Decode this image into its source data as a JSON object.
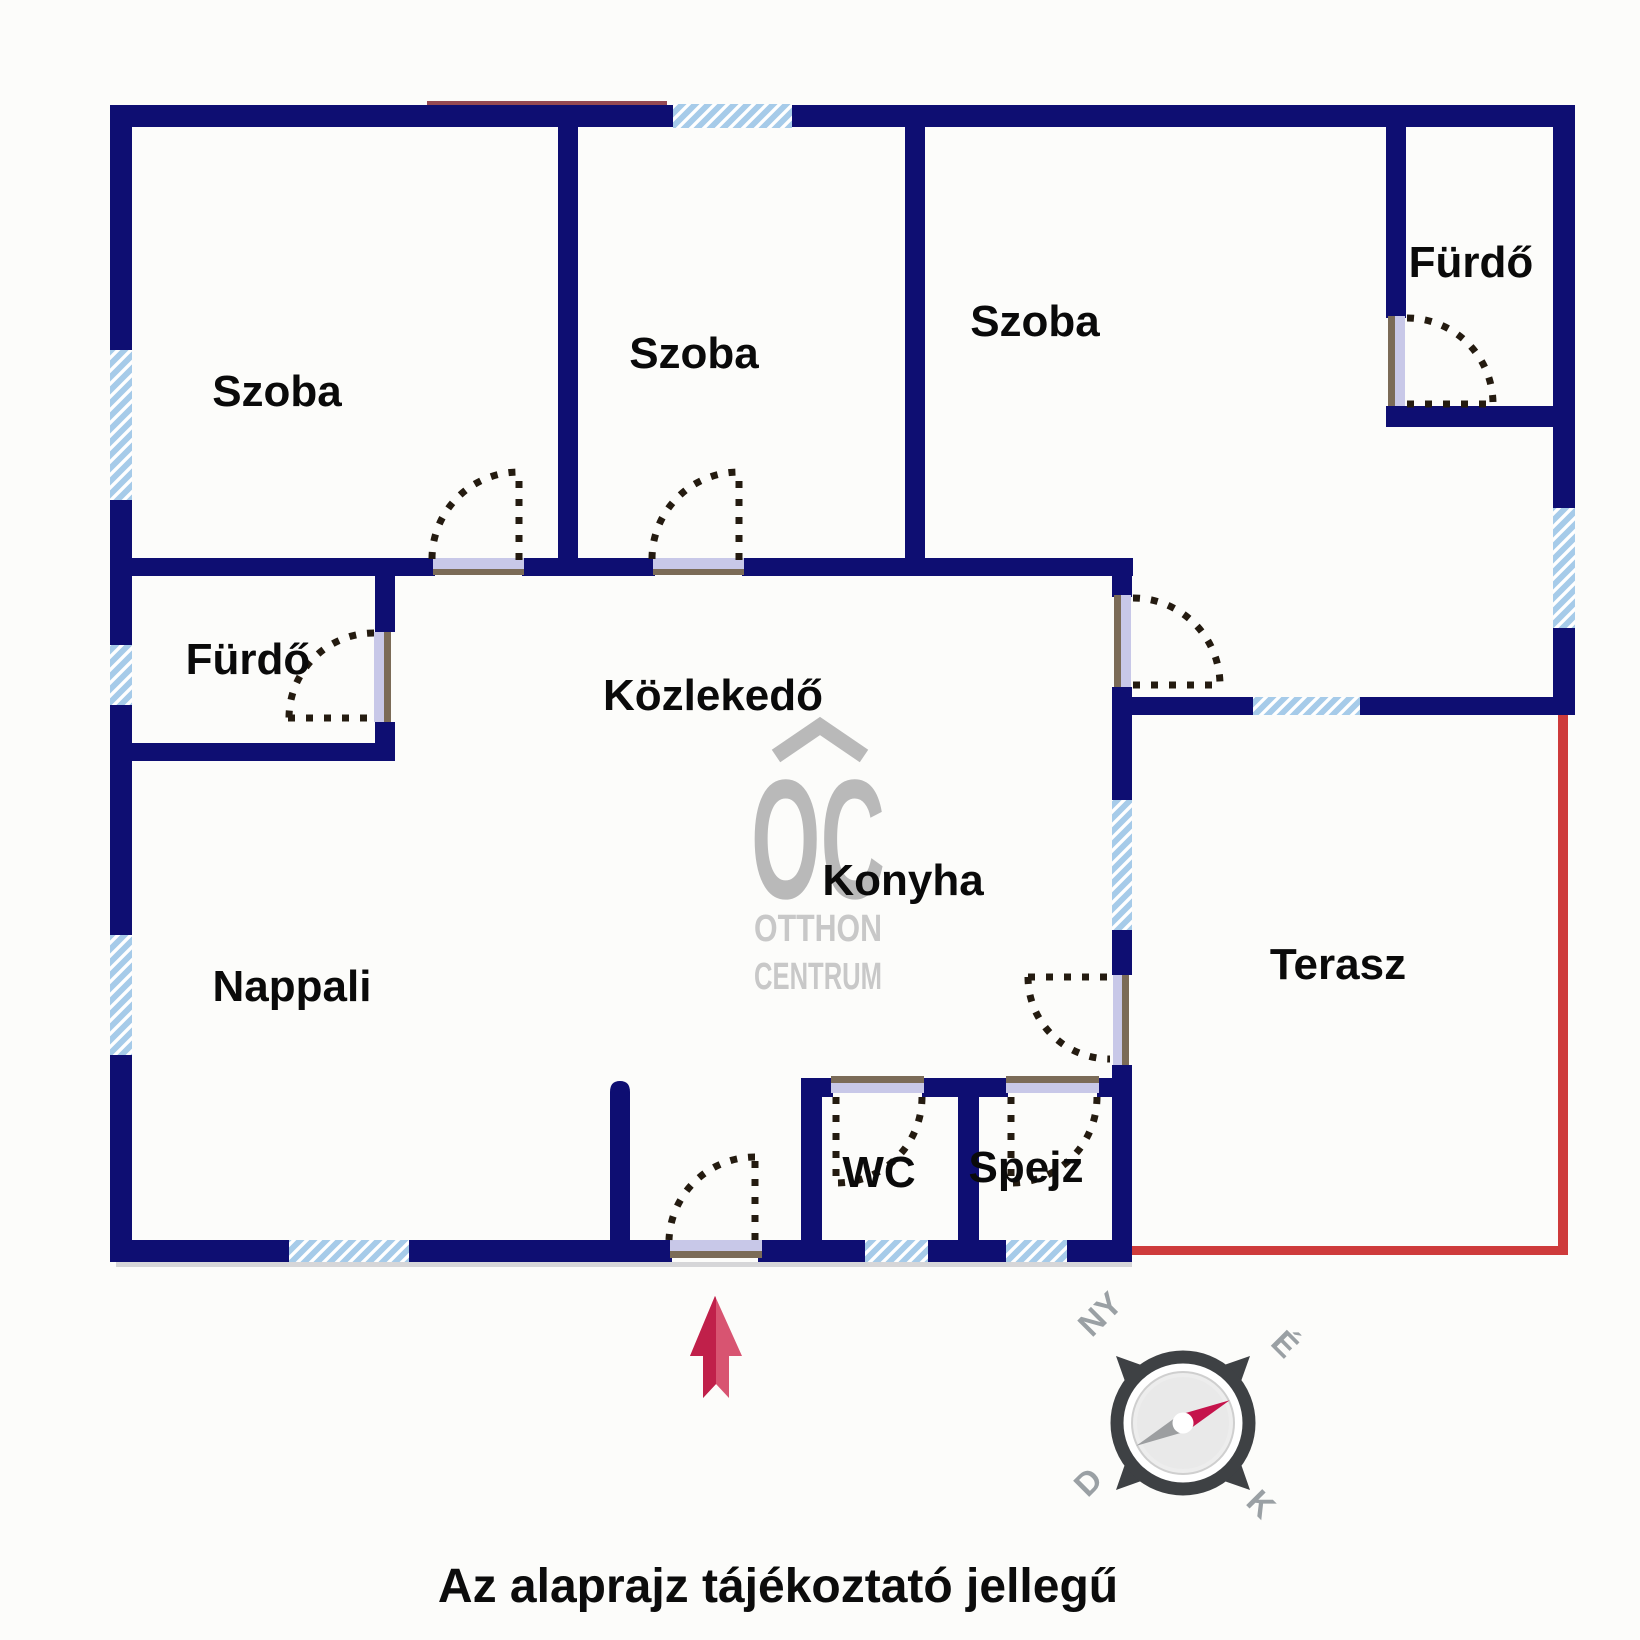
{
  "floorplan": {
    "rooms": [
      {
        "id": "szoba-1",
        "label": "Szoba"
      },
      {
        "id": "szoba-2",
        "label": "Szoba"
      },
      {
        "id": "szoba-3",
        "label": "Szoba"
      },
      {
        "id": "furdo-felso",
        "label": "Fürdő"
      },
      {
        "id": "furdo-also",
        "label": "Fürdő"
      },
      {
        "id": "kozlekedo",
        "label": "Közlekedő"
      },
      {
        "id": "konyha",
        "label": "Konyha"
      },
      {
        "id": "nappali",
        "label": "Nappali"
      },
      {
        "id": "terasz",
        "label": "Terasz"
      },
      {
        "id": "wc",
        "label": "WC"
      },
      {
        "id": "spejz",
        "label": "Spejz"
      }
    ],
    "caption": "Az alaprajz tájékoztató jellegű",
    "watermark": {
      "monogram": "OC",
      "line1": "OTTHON",
      "line2": "CENTRUM"
    },
    "compass": {
      "nw": "NY",
      "ne": "É",
      "sw": "D",
      "se": "K",
      "needle_points": "É"
    },
    "colors": {
      "wall": "#0e0e72",
      "window_fill": "#a6cbe9",
      "window_stripe": "#ffffff",
      "door_sill": "#c8c8e8",
      "door_sill_edge": "#7b6b57",
      "door_swing": "#241b10",
      "open_boundary_red": "#ce3b3b",
      "arrow_dark": "#c0204a",
      "arrow_light": "#d85471",
      "watermark_gray": "#b9b9b9",
      "compass_ring": "#3e4144",
      "compass_needle_red": "#c5134b",
      "compass_needle_gray": "#9c9ea0",
      "label_color": "#0a0a0a"
    }
  }
}
